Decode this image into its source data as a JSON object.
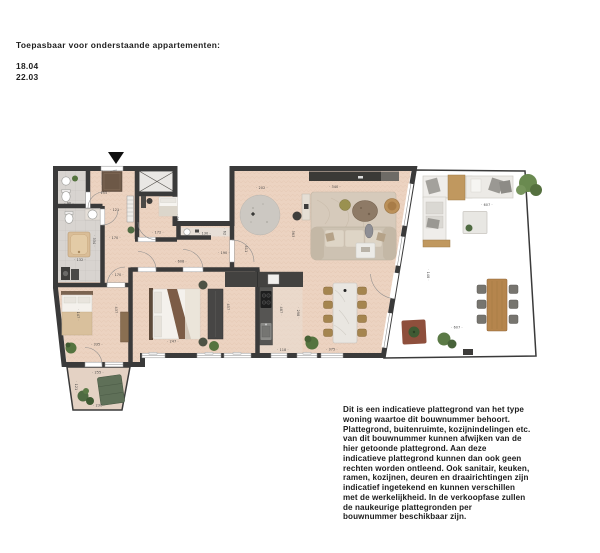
{
  "header": {
    "title": "Toepasbaar voor onderstaande appartementen:",
    "apartments": [
      "18.04",
      "22.03"
    ]
  },
  "disclaimer": "Dit is een indicatieve plattegrond van het type\nwoning waartoe dit bouwnummer behoort.\nPlattegrond, buitenruimte, kozijnindelingen etc.\nvan dit bouwnummer kunnen afwijken van de\nhier getoonde plattegrond. Aan deze\nindicatieve plattegrond kunnen dan ook geen\nrechten worden ontleend. Ook sanitair, keuken,\nramen, kozijnen, deuren en draairichtingen zijn\nindicatief ingetekend en kunnen verschillen\nmet de werkelijkheid. In de verkoopfase zullen\nde naukeurige plattegronden per\nbouwnummer beschikbaar zijn.",
  "plan": {
    "colors": {
      "wall": "#3a3a3a",
      "wood_floor": "#ecd3c1",
      "tile_floor": "#d8d4d0",
      "terrace_floor": "#ccc0b0",
      "balcony_floor": "#e4d2c4",
      "accent_green": "#55743f",
      "label": "#3c3c3c"
    },
    "dimension_labels": [
      {
        "t": "90",
        "x": 44,
        "y": 64.5,
        "r": 0
      },
      {
        "t": "155",
        "x": 79,
        "y": 54,
        "r": 0
      },
      {
        "t": "121",
        "x": 91,
        "y": 71,
        "r": 0
      },
      {
        "t": "170",
        "x": 90,
        "y": 99,
        "r": 0
      },
      {
        "t": "334",
        "x": 68,
        "y": 101,
        "r": 90
      },
      {
        "t": "132",
        "x": 55,
        "y": 121,
        "r": 0
      },
      {
        "t": "172",
        "x": 133,
        "y": 93.5,
        "r": 0
      },
      {
        "t": "253",
        "x": 151,
        "y": 80,
        "r": 90
      },
      {
        "t": "130",
        "x": 180,
        "y": 94.5,
        "r": 0
      },
      {
        "t": "62",
        "x": 198.5,
        "y": 93,
        "r": 90
      },
      {
        "t": "608",
        "x": 156,
        "y": 122.5,
        "r": 0
      },
      {
        "t": "411",
        "x": 220,
        "y": 109,
        "r": 90
      },
      {
        "t": "190",
        "x": 199,
        "y": 114,
        "r": 0
      },
      {
        "t": "170",
        "x": 93,
        "y": 136,
        "r": 0
      },
      {
        "t": "202",
        "x": 237,
        "y": 49,
        "r": 0
      },
      {
        "t": "340",
        "x": 310,
        "y": 48,
        "r": 0
      },
      {
        "t": "363",
        "x": 267,
        "y": 94,
        "r": 90
      },
      {
        "t": "457",
        "x": 202,
        "y": 167,
        "r": 90
      },
      {
        "t": "247",
        "x": 148,
        "y": 202.5,
        "r": 0
      },
      {
        "t": "487",
        "x": 255,
        "y": 170,
        "r": 90
      },
      {
        "t": "298",
        "x": 272,
        "y": 173,
        "r": 90
      },
      {
        "t": "118",
        "x": 258,
        "y": 211,
        "r": 0
      },
      {
        "t": "375",
        "x": 307,
        "y": 210.5,
        "r": 0
      },
      {
        "t": "147",
        "x": 52,
        "y": 175,
        "r": 90
      },
      {
        "t": "437",
        "x": 90,
        "y": 170,
        "r": 90
      },
      {
        "t": "335",
        "x": 72,
        "y": 205.5,
        "r": 0
      },
      {
        "t": "255",
        "x": 73,
        "y": 233.5,
        "r": 0
      },
      {
        "t": "121",
        "x": 50,
        "y": 247,
        "r": 90
      },
      {
        "t": "230",
        "x": 74,
        "y": 266.5,
        "r": 0
      },
      {
        "t": "607",
        "x": 462,
        "y": 66,
        "r": 0
      },
      {
        "t": "148",
        "x": 402,
        "y": 135,
        "r": 90
      },
      {
        "t": "607",
        "x": 432,
        "y": 188.5,
        "r": 0
      }
    ]
  }
}
